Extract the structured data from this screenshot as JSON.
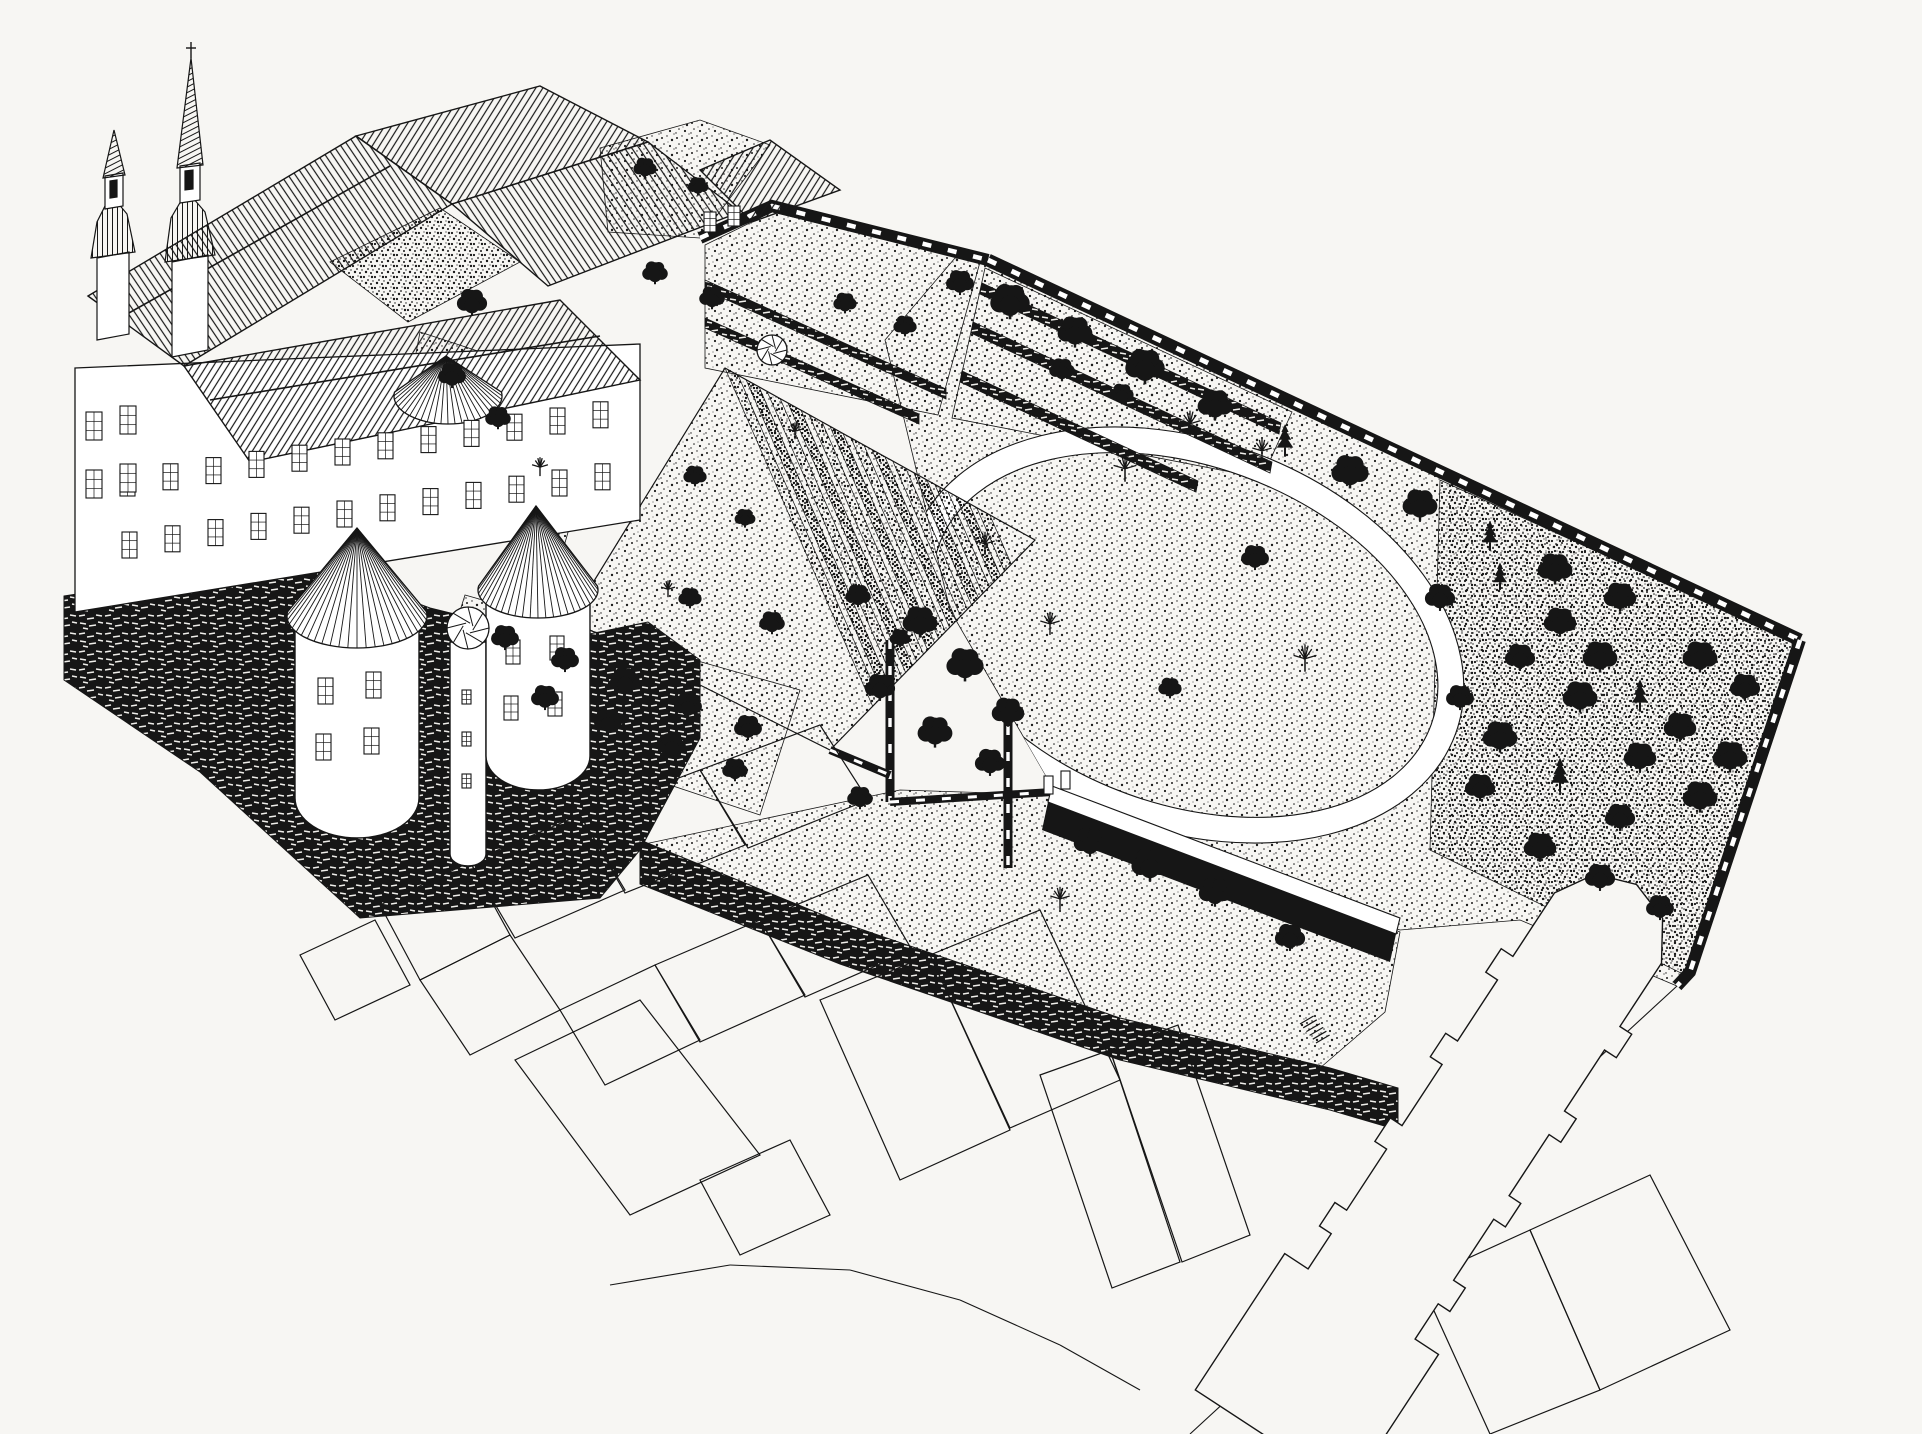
{
  "meta": {
    "kind": "axonometric bird's-eye ink drawing",
    "subject": "castle-monastery complex with walled gardens, tree park and town plot outlines"
  },
  "colors": {
    "bg": "#f7f6f3",
    "ink": "#161616",
    "paper": "#ffffff"
  },
  "scene": {
    "grounds": [
      {
        "name": "park-ground",
        "pts": "885,340 955,258 988,260 1800,640 1690,972 1677,986 1520,920 1400,930 1230,870 1060,800 950,610",
        "fill": "stipL"
      },
      {
        "name": "grove-ground",
        "pts": "1440,480 1795,642 1685,975 1430,850",
        "fill": "stipM"
      },
      {
        "name": "upper-terrace-garden",
        "pts": "985,268 1292,412 1262,478 952,418",
        "fill": "stipL"
      },
      {
        "name": "walled-court-garden",
        "pts": "705,245 772,212 980,262 938,415 705,368",
        "fill": "stipL"
      },
      {
        "name": "inner-courtyard",
        "pts": "330,262 440,208 520,262 408,322",
        "fill": "stipM"
      },
      {
        "name": "castle-south-garden",
        "pts": "420,332 608,394 560,560 392,480",
        "fill": "stipL"
      },
      {
        "name": "orchard",
        "pts": "465,595 800,690 760,815 430,705",
        "fill": "stipL"
      },
      {
        "name": "lower-terrace",
        "pts": "640,845 900,790 1055,795 1400,932 1385,1012 1320,1068 1120,1020 840,925",
        "fill": "stipL"
      },
      {
        "name": "north-garden-strip",
        "pts": "600,148 700,120 770,145 700,238 608,232",
        "fill": "stipL"
      }
    ],
    "ring": {
      "cx": 1185,
      "cy": 635,
      "rx": 275,
      "ry": 182,
      "rot": 20,
      "w": 26
    },
    "parkClip": "885,340 955,258 988,260 1800,640 1690,972 1677,986 1520,920 1400,930 1230,870 1060,800 950,610",
    "parterre": {
      "poly": "725,368 1035,540 830,750 570,620",
      "ex": 0.874,
      "ey": 0.485,
      "dx": 0.4,
      "dy": 0.916,
      "n": 13,
      "gap": 24,
      "w": 15,
      "len": 470
    },
    "hedgeBands": [
      {
        "pts": "982,283 1281,423 1279,434 980,294"
      },
      {
        "pts": "973,322 1272,462 1270,473 971,333"
      },
      {
        "pts": "962,371 1198,481 1196,492 960,382"
      },
      {
        "pts": "705,280 946,389 946,399 705,290"
      },
      {
        "pts": "705,318 919,414 919,424 705,328"
      }
    ],
    "wallsStroke": [
      {
        "name": "garden-north-wall",
        "pts": "700,238 772,206 988,260",
        "w": 12
      },
      {
        "name": "park-crenellated-wall",
        "pts": "988,260 1800,640",
        "w": 13
      },
      {
        "name": "grove-east-wall",
        "pts": "1800,640 1690,972 1677,986",
        "w": 12
      },
      {
        "name": "gate-wall-a",
        "pts": "890,640 890,802",
        "w": 9
      },
      {
        "name": "gate-wall-b",
        "pts": "1008,700 1008,868",
        "w": 9
      },
      {
        "name": "terrace-top-wall",
        "pts": "890,802 1052,792",
        "w": 8
      },
      {
        "name": "parterre-hedge",
        "pts": "830,750 890,775",
        "w": 8
      }
    ],
    "canalWhite": "1052,786 1400,918 1396,934 1048,802",
    "canalDark": "1048,802 1396,934 1390,962 1042,830",
    "rubble": [
      {
        "name": "castle-bastion-base",
        "pts": "64,596 300,560 430,608 560,640 648,622 700,660 700,738 640,850 600,898 360,918 200,772 64,680"
      },
      {
        "name": "rampart-wall",
        "pts": "640,840 840,922 1120,1018 1330,1068 1398,1088 1398,1130 1330,1110 1120,1060 840,964 640,884"
      }
    ],
    "facades": [
      {
        "name": "main-facade",
        "pts": "75,368 640,344 640,520 75,612"
      }
    ],
    "roofs": [
      {
        "name": "church-nave-roof",
        "pts": "88,296 356,136 452,204 184,366",
        "h": "h2"
      },
      {
        "name": "north-wing-roof",
        "pts": "356,136 540,86 648,142 452,204",
        "h": "h1"
      },
      {
        "name": "east-wing-roof",
        "pts": "452,204 648,142 740,212 548,286",
        "h": "h2"
      },
      {
        "name": "outbuilding-roof",
        "pts": "700,170 770,140 840,190 752,222",
        "h": "h1"
      },
      {
        "name": "south-wing-roof",
        "pts": "184,366 560,300 640,380 250,462",
        "h": "h1"
      }
    ],
    "ridges": [
      {
        "x1": 120,
        "y1": 318,
        "x2": 390,
        "y2": 166
      },
      {
        "x1": 210,
        "y1": 400,
        "x2": 600,
        "y2": 336
      }
    ],
    "cylinders": [
      {
        "name": "west-round-tower",
        "d": "M295,612 L295,798 A62,40 0 0 0 419,798 L419,612 Z"
      },
      {
        "name": "stair-turret",
        "d": "M450,642 L450,854 A18,12 0 0 0 486,854 L486,642 Z"
      },
      {
        "name": "south-round-tower",
        "d": "M486,592 L486,756 A52,34 0 0 0 590,756 L590,592 Z"
      }
    ],
    "cones": [
      {
        "name": "west-tower-cone",
        "ax": 357,
        "ay": 528,
        "cx": 357,
        "cy": 616,
        "rx": 70,
        "ry": 32
      },
      {
        "name": "south-tower-cone",
        "ax": 536,
        "ay": 506,
        "cx": 538,
        "cy": 590,
        "rx": 60,
        "ry": 28
      },
      {
        "name": "northwest-tower-cone",
        "ax": 446,
        "ay": 356,
        "cx": 448,
        "cy": 396,
        "rx": 54,
        "ry": 28
      }
    ],
    "spirals": [
      {
        "cx": 468,
        "cy": 628,
        "r": 21
      },
      {
        "cx": 772,
        "cy": 350,
        "r": 15
      }
    ],
    "windowRows": [
      {
        "x": 120,
        "y": 470,
        "dx": 43,
        "dy": -6.2,
        "n": 12,
        "w": 15,
        "h": 26
      },
      {
        "x": 122,
        "y": 532,
        "dx": 43,
        "dy": -6.2,
        "n": 12,
        "w": 15,
        "h": 26
      },
      {
        "x": 86,
        "y": 412,
        "dx": 34,
        "dy": -6,
        "n": 2,
        "w": 16,
        "h": 28
      },
      {
        "x": 86,
        "y": 470,
        "dx": 34,
        "dy": -6,
        "n": 2,
        "w": 16,
        "h": 28
      },
      {
        "x": 318,
        "y": 678,
        "dx": 48,
        "dy": -6,
        "n": 2,
        "w": 15,
        "h": 26
      },
      {
        "x": 316,
        "y": 734,
        "dx": 48,
        "dy": -6,
        "n": 2,
        "w": 15,
        "h": 26
      },
      {
        "x": 506,
        "y": 640,
        "dx": 44,
        "dy": -4,
        "n": 2,
        "w": 14,
        "h": 24
      },
      {
        "x": 504,
        "y": 696,
        "dx": 44,
        "dy": -4,
        "n": 2,
        "w": 14,
        "h": 24
      },
      {
        "x": 462,
        "y": 690,
        "dx": 0,
        "dy": 42,
        "n": 3,
        "w": 9,
        "h": 14
      },
      {
        "x": 704,
        "y": 212,
        "dx": 24,
        "dy": -6,
        "n": 2,
        "w": 12,
        "h": 20
      }
    ],
    "spires": [
      {
        "pts": "97,258 129,252 129,334 97,340",
        "f": "paper"
      },
      {
        "pts": "91,258 135,252 127,214 117,202 105,206 97,222",
        "f": "h3"
      },
      {
        "pts": "105,176 123,173 123,206 105,209",
        "f": "paper"
      },
      {
        "pts": "110,181 117,180 117,197 110,198",
        "f": "ink"
      },
      {
        "pts": "103,178 125,175 114,130",
        "f": "h4"
      },
      {
        "pts": "172,262 208,255 208,350 172,357",
        "f": "paper"
      },
      {
        "pts": "165,262 215,255 205,212 193,198 181,201 171,218",
        "f": "h3"
      },
      {
        "pts": "180,166 200,163 200,200 180,203",
        "f": "paper"
      },
      {
        "pts": "185,171 193,170 193,189 185,190",
        "f": "ink"
      },
      {
        "pts": "177,168 203,165 191,58",
        "f": "h4"
      }
    ],
    "spireCross": [
      {
        "x1": 191,
        "y1": 58,
        "x2": 191,
        "y2": 42
      },
      {
        "x1": 186,
        "y1": 48,
        "x2": 196,
        "y2": 48
      }
    ],
    "church": {
      "ax": 1608,
      "ay": 928,
      "bx": 1300,
      "by": 1398,
      "halfW": 64,
      "f": [
        0.16,
        0.34,
        0.52,
        0.7
      ],
      "but": 14,
      "bl": 0.025,
      "westF": 0.8,
      "westW": 92,
      "endF": 1.09
    },
    "parcels": [
      "380,905 470,862 510,935 420,980",
      "420,980 510,935 560,1010 470,1055",
      "300,955 375,920 410,985 335,1020",
      "470,862 580,815 625,890 515,938",
      "560,1010 655,965 700,1040 605,1085",
      "580,815 700,770 745,845 625,893",
      "700,770 820,725 868,800 748,848",
      "655,965 760,920 805,995 700,1042",
      "760,920 868,875 912,950 805,997",
      "515,1060 640,1000 760,1155 630,1215",
      "820,1000 930,955 1010,1130 900,1180",
      "930,955 1040,910 1120,1080 1010,1128",
      "1040,1075 1110,1050 1180,1262 1112,1288",
      "1110,1050 1178,1025 1250,1235 1182,1262",
      "700,1180 790,1140 830,1215 740,1255",
      "1420,1280 1530,1230 1600,1390 1490,1434",
      "1530,1230 1650,1175 1730,1330 1600,1390"
    ],
    "lines": [
      {
        "x1": 1677,
        "y1": 986,
        "x2": 1190,
        "y2": 1434
      },
      {
        "x1": 610,
        "y1": 1285,
        "x2": 730,
        "y2": 1265
      },
      {
        "x1": 730,
        "y1": 1265,
        "x2": 850,
        "y2": 1270
      },
      {
        "x1": 850,
        "y1": 1270,
        "x2": 960,
        "y2": 1300
      },
      {
        "x1": 960,
        "y1": 1300,
        "x2": 1060,
        "y2": 1345
      },
      {
        "x1": 1060,
        "y1": 1345,
        "x2": 1140,
        "y2": 1390
      }
    ],
    "gatePosts": [
      {
        "x": 1044,
        "y": 776
      },
      {
        "x": 1061,
        "y": 771
      }
    ],
    "stairs": {
      "x": 1300,
      "y": 1024,
      "n": 6,
      "sx": 3.2,
      "sy": 3.8,
      "len": 16
    },
    "trees": [
      [
        1125,
        470,
        26,
        "B"
      ],
      [
        1255,
        560,
        24,
        "L"
      ],
      [
        1050,
        625,
        22,
        "B"
      ],
      [
        1305,
        660,
        26,
        "B"
      ],
      [
        1170,
        690,
        20,
        "L"
      ],
      [
        985,
        545,
        22,
        "B"
      ],
      [
        960,
        285,
        24,
        "L"
      ],
      [
        1010,
        305,
        34,
        "L"
      ],
      [
        1075,
        335,
        30,
        "L"
      ],
      [
        1145,
        370,
        34,
        "L"
      ],
      [
        1215,
        408,
        30,
        "L"
      ],
      [
        1285,
        445,
        26,
        "C"
      ],
      [
        1350,
        475,
        32,
        "L"
      ],
      [
        1420,
        508,
        30,
        "L"
      ],
      [
        1490,
        540,
        24,
        "C"
      ],
      [
        1555,
        572,
        30,
        "L"
      ],
      [
        1620,
        600,
        28,
        "L"
      ],
      [
        1700,
        660,
        30,
        "L"
      ],
      [
        1745,
        690,
        26,
        "L"
      ],
      [
        1680,
        730,
        28,
        "L"
      ],
      [
        1730,
        760,
        30,
        "L"
      ],
      [
        1640,
        700,
        26,
        "C"
      ],
      [
        1600,
        660,
        30,
        "L"
      ],
      [
        1560,
        625,
        28,
        "L"
      ],
      [
        1520,
        660,
        26,
        "L"
      ],
      [
        1580,
        700,
        30,
        "L"
      ],
      [
        1640,
        760,
        28,
        "L"
      ],
      [
        1700,
        800,
        30,
        "L"
      ],
      [
        1620,
        820,
        26,
        "L"
      ],
      [
        1560,
        780,
        28,
        "C"
      ],
      [
        1500,
        740,
        30,
        "L"
      ],
      [
        1460,
        700,
        24,
        "L"
      ],
      [
        1480,
        790,
        26,
        "L"
      ],
      [
        1540,
        850,
        28,
        "L"
      ],
      [
        1600,
        880,
        26,
        "L"
      ],
      [
        1660,
        910,
        24,
        "L"
      ],
      [
        1440,
        600,
        26,
        "L"
      ],
      [
        1500,
        580,
        22,
        "C"
      ],
      [
        920,
        625,
        30,
        "L"
      ],
      [
        965,
        668,
        32,
        "L"
      ],
      [
        1008,
        715,
        28,
        "L"
      ],
      [
        880,
        690,
        26,
        "L"
      ],
      [
        935,
        735,
        30,
        "L"
      ],
      [
        990,
        765,
        26,
        "L"
      ],
      [
        1090,
        845,
        28,
        "L"
      ],
      [
        1150,
        868,
        32,
        "L"
      ],
      [
        1215,
        895,
        28,
        "L"
      ],
      [
        1060,
        900,
        22,
        "B"
      ],
      [
        1290,
        940,
        26,
        "L"
      ],
      [
        860,
        800,
        22,
        "L"
      ],
      [
        505,
        640,
        24,
        "L"
      ],
      [
        565,
        662,
        24,
        "L"
      ],
      [
        625,
        684,
        26,
        "L"
      ],
      [
        688,
        708,
        24,
        "L"
      ],
      [
        748,
        730,
        24,
        "L"
      ],
      [
        545,
        700,
        24,
        "L"
      ],
      [
        608,
        724,
        24,
        "L"
      ],
      [
        672,
        748,
        24,
        "L"
      ],
      [
        735,
        772,
        22,
        "L"
      ],
      [
        695,
        478,
        20,
        "L"
      ],
      [
        745,
        520,
        18,
        "L"
      ],
      [
        858,
        598,
        22,
        "L"
      ],
      [
        900,
        640,
        18,
        "L"
      ],
      [
        795,
        432,
        16,
        "B"
      ],
      [
        668,
        590,
        16,
        "B"
      ],
      [
        452,
        378,
        24,
        "L"
      ],
      [
        498,
        420,
        22,
        "L"
      ],
      [
        472,
        305,
        26,
        "L"
      ],
      [
        540,
        468,
        18,
        "B"
      ],
      [
        655,
        275,
        22,
        "L"
      ],
      [
        712,
        300,
        22,
        "L"
      ],
      [
        845,
        305,
        20,
        "L"
      ],
      [
        905,
        328,
        20,
        "L"
      ],
      [
        1062,
        372,
        22,
        "L"
      ],
      [
        1122,
        396,
        20,
        "L"
      ],
      [
        1190,
        425,
        24,
        "B"
      ],
      [
        1262,
        452,
        22,
        "B"
      ],
      [
        645,
        170,
        20,
        "L"
      ],
      [
        698,
        188,
        18,
        "L"
      ],
      [
        690,
        600,
        20,
        "L"
      ],
      [
        772,
        625,
        22,
        "L"
      ]
    ]
  }
}
